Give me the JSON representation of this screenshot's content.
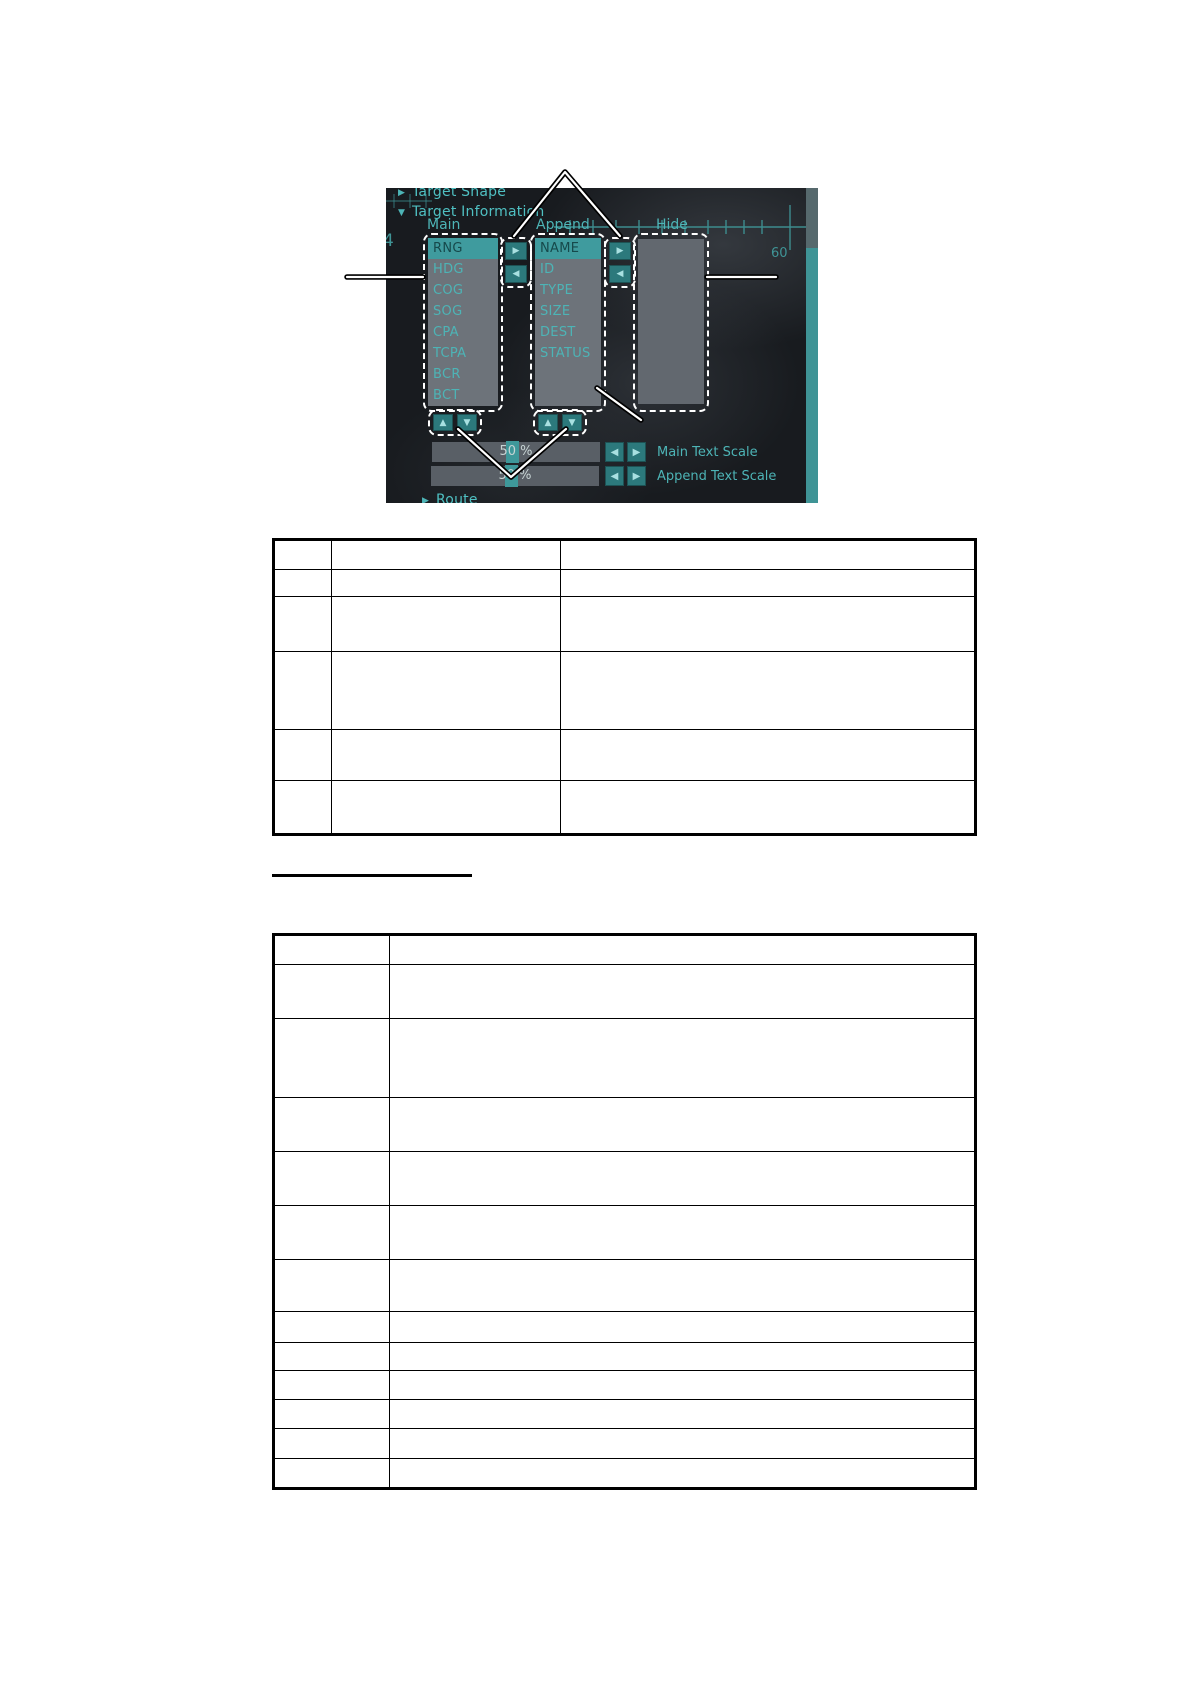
{
  "screenshot": {
    "sections": {
      "target_shape": "Target Shape",
      "target_information": "Target Information",
      "route": "Route"
    },
    "columns": {
      "main": "Main",
      "append": "Append",
      "hide": "Hide"
    },
    "main_list": {
      "items": [
        "RNG",
        "HDG",
        "COG",
        "SOG",
        "CPA",
        "TCPA",
        "BCR",
        "BCT"
      ],
      "selected": "RNG"
    },
    "append_list": {
      "items": [
        "NAME",
        "ID",
        "TYPE",
        "SIZE",
        "DEST",
        "STATUS"
      ],
      "selected": "NAME"
    },
    "hide_list": {
      "items": []
    },
    "move_buttons": {
      "right": "▶",
      "left": "◀",
      "up": "▲",
      "down": "▼"
    },
    "sliders": [
      {
        "value": "50 %",
        "label": "Main Text Scale"
      },
      {
        "value": "50 %",
        "label": "Append Text Scale"
      }
    ],
    "radar_numbers": {
      "left": "4",
      "right": "60"
    },
    "colors": {
      "panel_bg": "#181b1f",
      "teal_text": "#4db4b6",
      "selected_bg": "#3f9b9e",
      "list_bg": "#6d737a",
      "button_bg": "#2c797c",
      "slider_bg": "#595f66",
      "scrollbar_thumb": "#3f9496"
    }
  },
  "tables": {
    "table1": {
      "col_widths": [
        56,
        228,
        413
      ],
      "row_heights": [
        28,
        26,
        54,
        77,
        50,
        52
      ],
      "left": 272,
      "top": 538
    },
    "table2": {
      "col_widths": [
        114,
        584
      ],
      "row_heights": [
        28,
        53,
        78,
        53,
        53,
        53,
        51,
        30,
        27,
        28,
        28,
        29,
        28
      ],
      "left": 272,
      "top": 933
    }
  }
}
